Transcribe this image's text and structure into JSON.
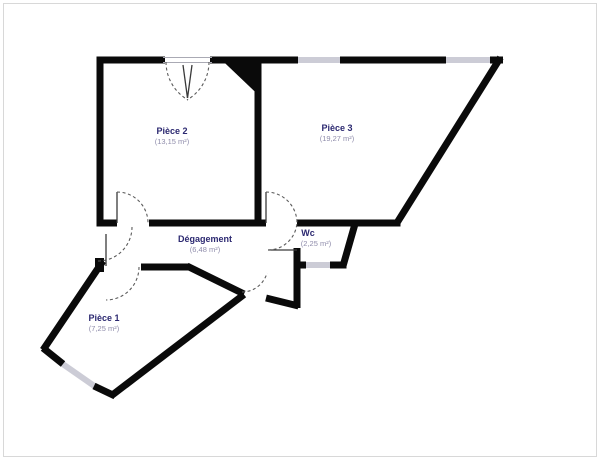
{
  "plan": {
    "rooms": [
      {
        "name": "Pièce 2",
        "area": "(13,15 m²)"
      },
      {
        "name": "Pièce 3",
        "area": "(19,27 m²)"
      },
      {
        "name": "Dégagement",
        "area": "(6,48 m²)"
      },
      {
        "name": "Wc",
        "area": "(2,25 m²)"
      },
      {
        "name": "Pièce 1",
        "area": "(7,25 m²)"
      }
    ],
    "colors": {
      "wall": "#0a0a0a",
      "window": "#ccccd6",
      "room_label": "#2b2870",
      "area_label": "#8f8cab",
      "background": "#ffffff",
      "frame": "#d8d8d8"
    }
  }
}
